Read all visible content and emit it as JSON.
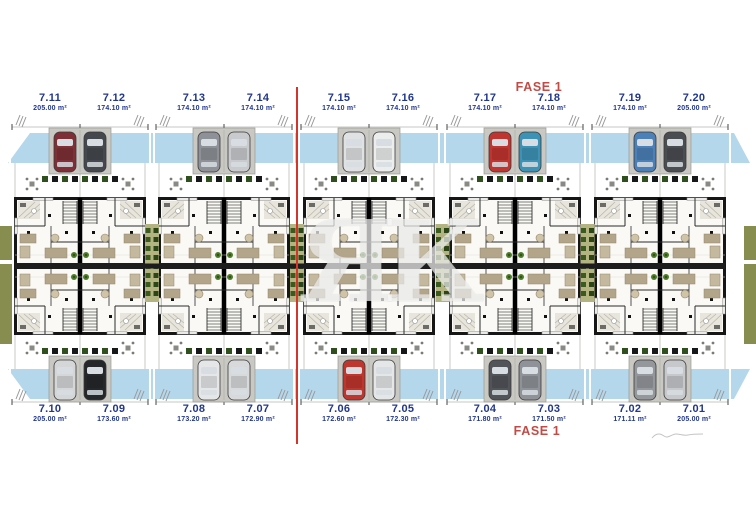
{
  "phase": {
    "top": "FASE 1",
    "bottom": "FASE 1"
  },
  "watermark": {
    "text": "ЯК"
  },
  "area_unit": "m²",
  "units_top": [
    {
      "id": "7.11",
      "area": "205.00 m²"
    },
    {
      "id": "7.12",
      "area": "174.10 m²"
    },
    {
      "id": "7.13",
      "area": "174.10 m²"
    },
    {
      "id": "7.14",
      "area": "174.10 m²"
    },
    {
      "id": "7.15",
      "area": "174.10 m²"
    },
    {
      "id": "7.16",
      "area": "174.10 m²"
    },
    {
      "id": "7.17",
      "area": "174.10 m²"
    },
    {
      "id": "7.18",
      "area": "174.10 m²"
    },
    {
      "id": "7.19",
      "area": "174.10 m²"
    },
    {
      "id": "7.20",
      "area": "205.00 m²"
    }
  ],
  "units_bottom": [
    {
      "id": "7.10",
      "area": "205.00 m²"
    },
    {
      "id": "7.09",
      "area": "173.60 m²"
    },
    {
      "id": "7.08",
      "area": "173.20 m²"
    },
    {
      "id": "7.07",
      "area": "172.90 m²"
    },
    {
      "id": "7.06",
      "area": "172.60 m²"
    },
    {
      "id": "7.05",
      "area": "172.30 m²"
    },
    {
      "id": "7.04",
      "area": "171.80 m²"
    },
    {
      "id": "7.03",
      "area": "171.50 m²"
    },
    {
      "id": "7.02",
      "area": "171.11 m²"
    },
    {
      "id": "7.01",
      "area": "205.00 m²"
    }
  ],
  "cars_top": [
    [
      "#7e3036",
      "#45484e"
    ],
    [
      "#8e9298",
      "#c9cacd"
    ],
    [
      "#dfe1e3",
      "#eceded"
    ],
    [
      "#c13530",
      "#3d93b5"
    ],
    [
      "#4b80b8",
      "#4a4d52"
    ]
  ],
  "cars_bottom": [
    [
      "#d5d6d8",
      "#26272b"
    ],
    [
      "#e5e6e7",
      "#d8d9db"
    ],
    [
      "#bf362e",
      "#e5e6e7"
    ],
    [
      "#515459",
      "#8f9298"
    ],
    [
      "#94979c",
      "#c7c8cb"
    ]
  ],
  "colors": {
    "label_blue": "#22378c",
    "phase_red": "#c24b46",
    "divider_red": "#d2352a",
    "pavement_blue": "#b5d7ec",
    "driveway_gray": "#c9c8c2",
    "wall_black": "#161616",
    "hedge_green": "#3a5a1e",
    "hedge_background": "#b4b482",
    "furniture_tan": "#b3a58a"
  }
}
